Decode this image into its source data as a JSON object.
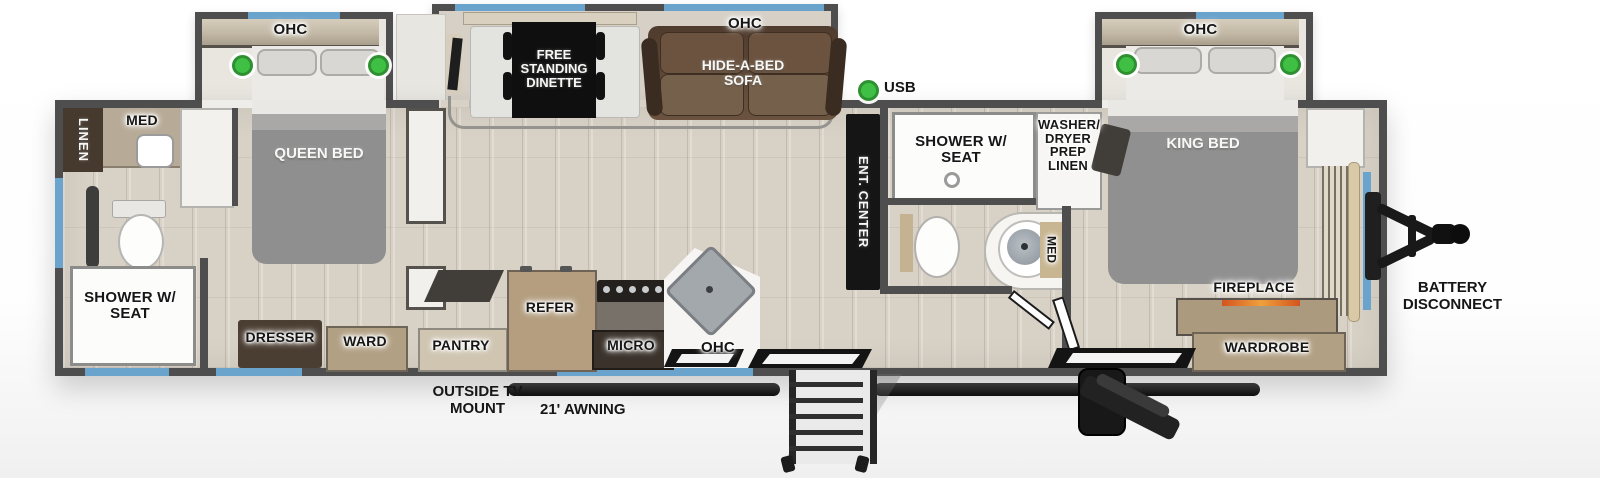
{
  "floorplan": {
    "slides": {
      "queen": {
        "ohc": "OHC"
      },
      "living": {
        "ohc": "OHC",
        "dinette": "FREE STANDING DINETTE",
        "sofa": "HIDE-A-BED SOFA"
      },
      "king": {
        "ohc": "OHC"
      }
    },
    "rooms": {
      "rear_bath": {
        "linen": "LINEN",
        "med": "MED",
        "shower": "SHOWER W/ SEAT"
      },
      "queen_bedroom": {
        "bed": "QUEEN BED",
        "dresser": "DRESSER",
        "ward": "WARD"
      },
      "kitchen": {
        "pantry": "PANTRY",
        "refer": "REFER",
        "micro": "MICRO",
        "ohc": "OHC"
      },
      "living": {
        "ent_center": "ENT. CENTER",
        "usb": "USB"
      },
      "mid_bath": {
        "shower": "SHOWER W/ SEAT",
        "washer_dryer": "WASHER/ DRYER PREP LINEN",
        "med": "MED"
      },
      "king_bedroom": {
        "bed": "KING BED",
        "fireplace": "FIREPLACE",
        "wardrobe": "WARDROBE"
      }
    },
    "exterior": {
      "battery_disconnect": "BATTERY DISCONNECT",
      "outside_tv_mount": "OUTSIDE TV MOUNT",
      "awning": "21' AWNING"
    },
    "colors": {
      "accent_window_blue": "#6aa3cc",
      "led_green": "#3fbf44",
      "wall_gray": "#4e4e4e",
      "floor_wood": "#d8d1c6",
      "sofa_brown": "#5d4835",
      "cabinet_tan": "#b2a084"
    }
  }
}
